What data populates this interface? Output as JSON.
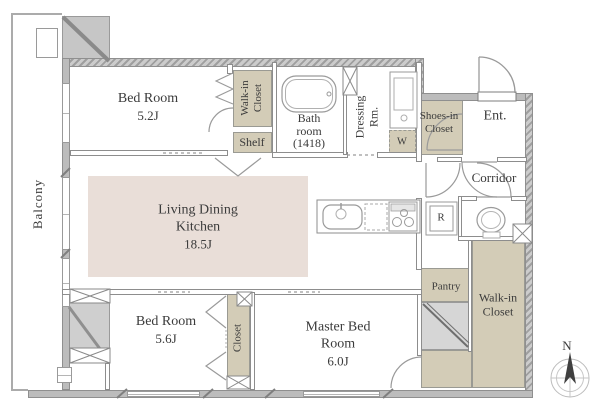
{
  "plan": {
    "balcony_label": "Balcony",
    "bedroom1": {
      "name": "Bed Room",
      "size": "5.2J"
    },
    "wic_top": {
      "line1": "Walk-in",
      "line2": "Closet"
    },
    "shelf_label": "Shelf",
    "bathroom": {
      "line1": "Bath",
      "line2": "room",
      "size": "(1418)"
    },
    "dressing": {
      "line1": "Dressing",
      "line2": "Rm."
    },
    "washer_label": "W",
    "shoes_closet": {
      "line1": "Shoes-in",
      "line2": "Closet"
    },
    "entrance_label": "Ent.",
    "corridor_label": "Corridor",
    "ldk": {
      "line1": "Living Dining",
      "line2": "Kitchen",
      "size": "18.5J"
    },
    "fridge_label": "R",
    "bedroom2": {
      "name": "Bed Room",
      "size": "5.6J"
    },
    "closet_label": "Closet",
    "master_bedroom": {
      "line1": "Master Bed",
      "line2": "Room",
      "size": "6.0J"
    },
    "pantry_label": "Pantry",
    "wic_right": {
      "line1": "Walk-in",
      "line2": "Closet"
    },
    "compass_north_label": "N",
    "colors": {
      "closet_fill": "#d3ccb7",
      "ldk_fill": "#e9ded8",
      "exterior_wall": "#bcbcbc",
      "duct_fill": "#d6d6d6",
      "text": "#3b3b3b"
    }
  }
}
